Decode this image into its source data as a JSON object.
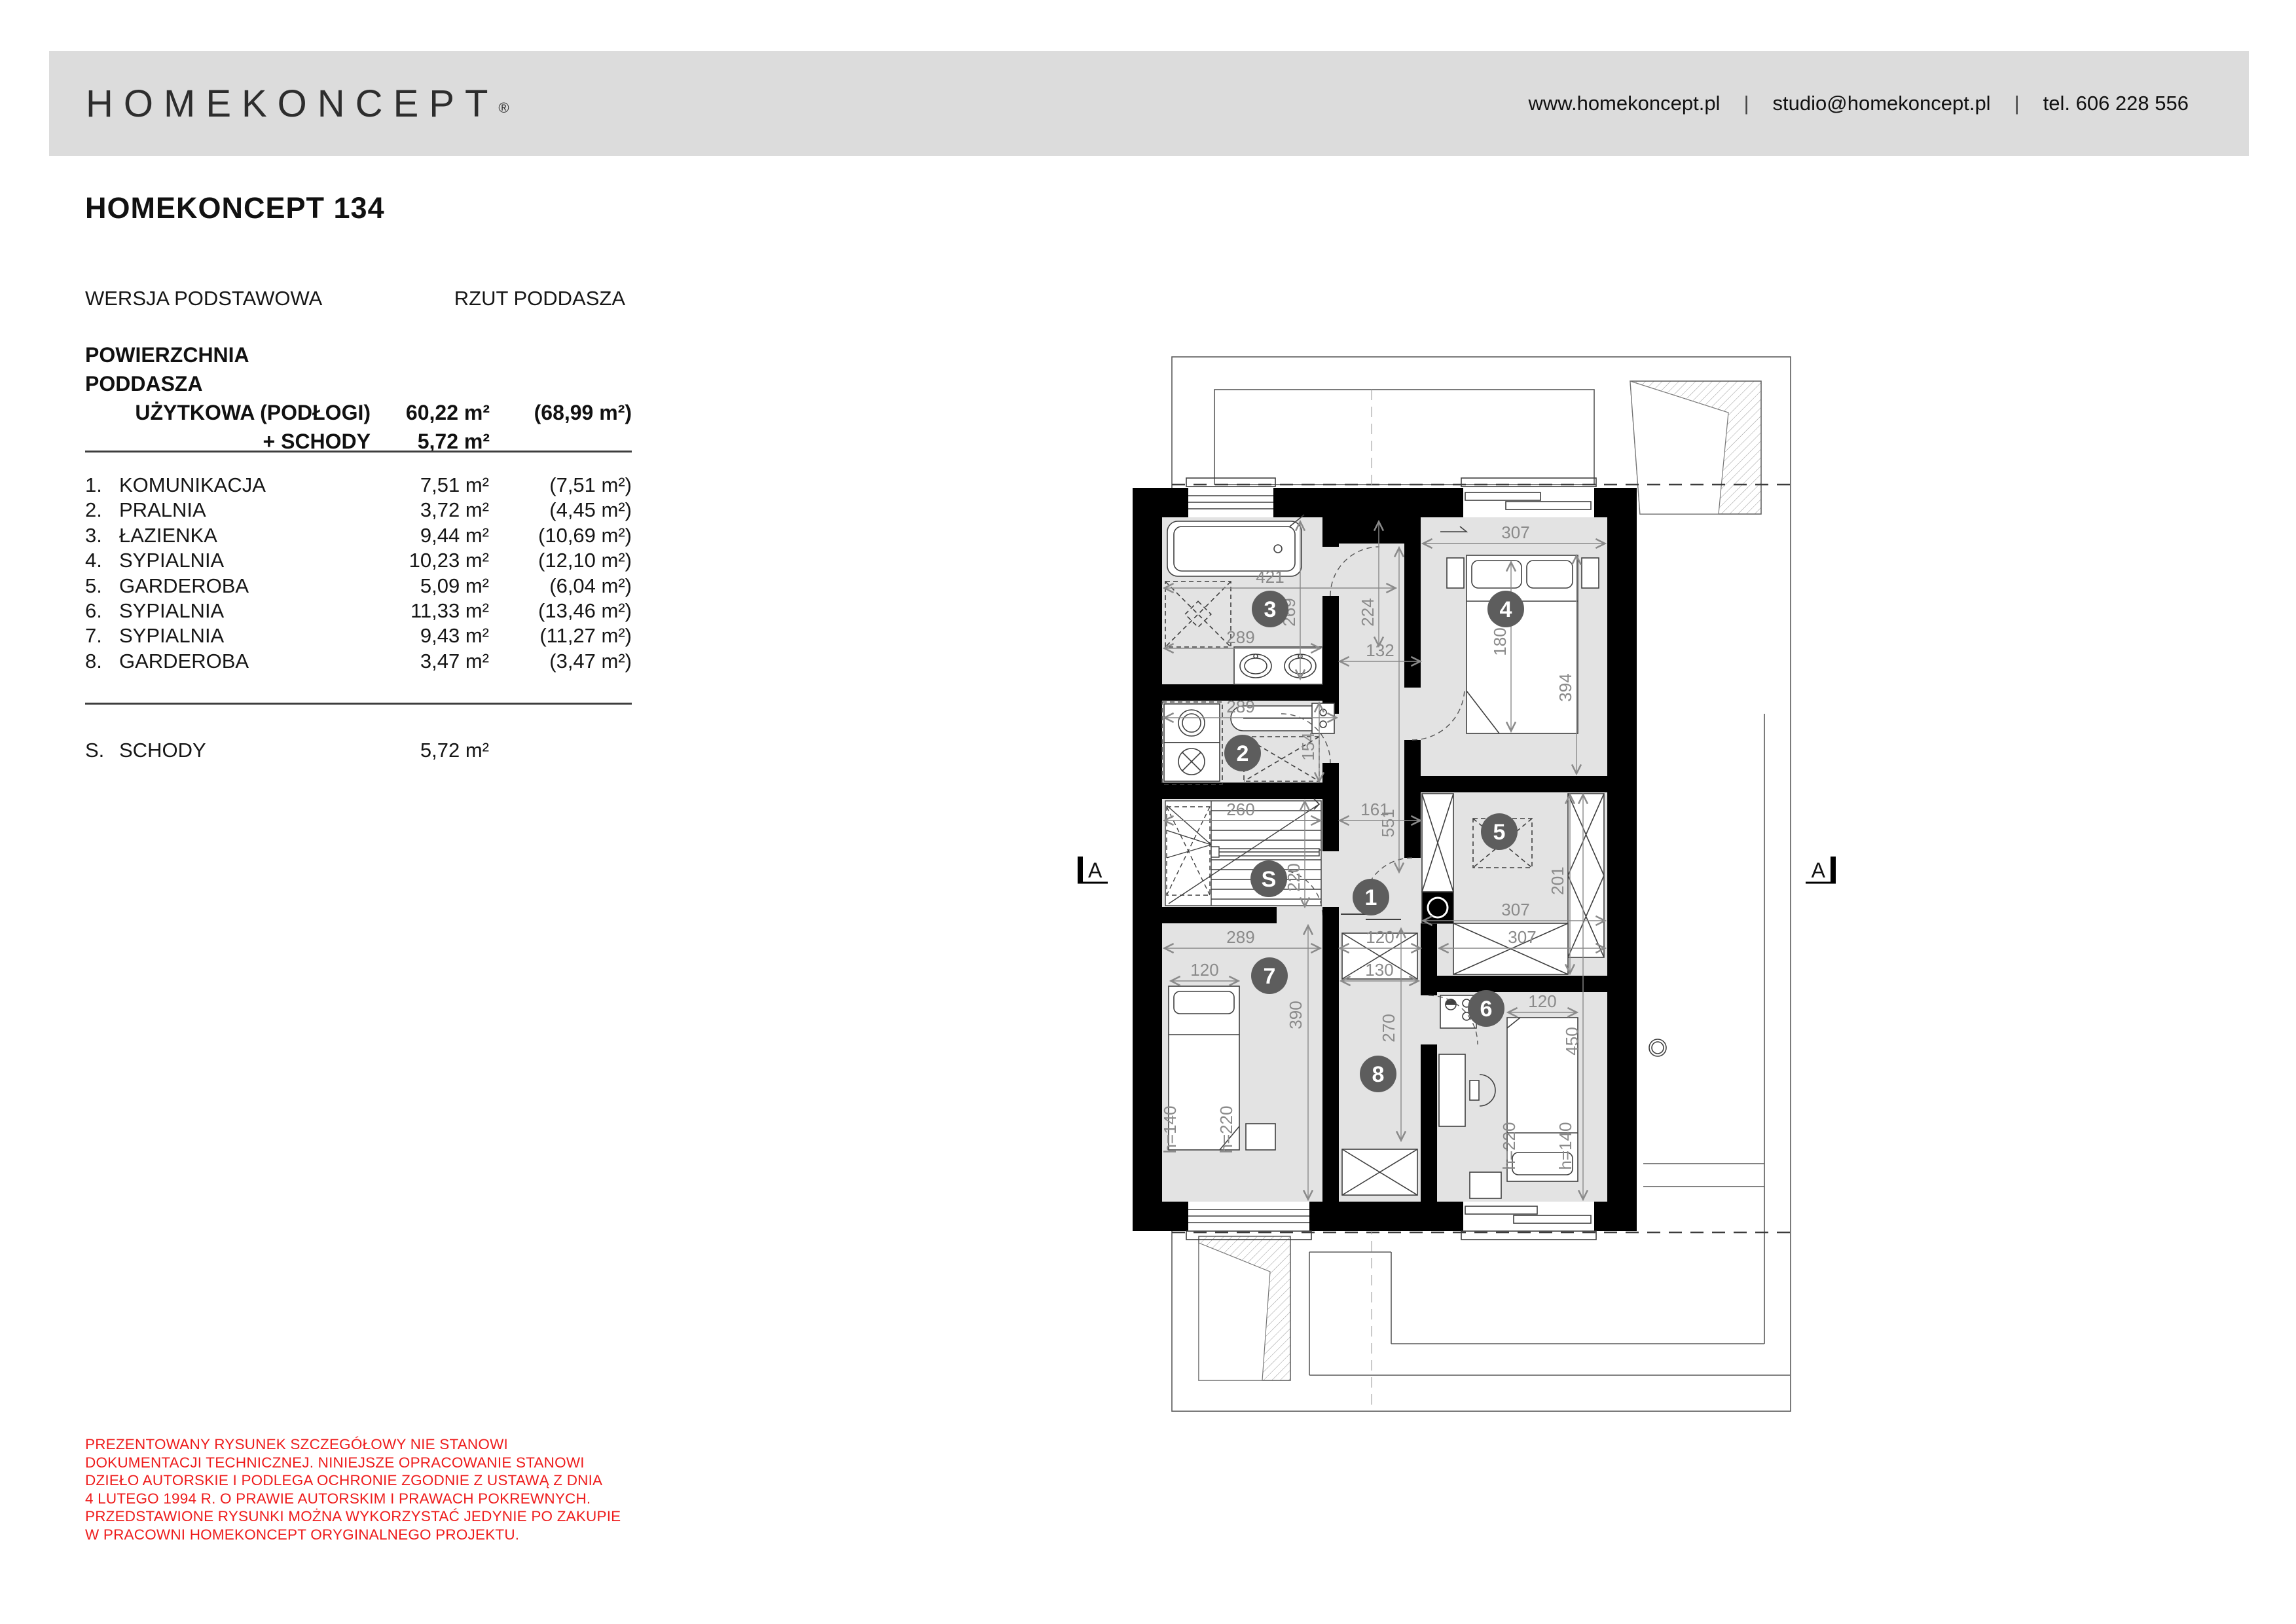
{
  "colors": {
    "header_bg": "#dcdcdc",
    "text": "#111111",
    "disclaimer_red": "#ee1c1c",
    "room_fill": "#e3e3e3",
    "wall": "#000000",
    "room_circle": "#5d5d5d",
    "dimension_gray": "#8a8a8a"
  },
  "header": {
    "logo": "HOMEKONCEPT",
    "reg": "®",
    "website": "www.homekoncept.pl",
    "separator": "|",
    "email": "studio@homekoncept.pl",
    "phone": "tel. 606 228 556"
  },
  "title": "HOMEKONCEPT 134",
  "meta": {
    "version": "WERSJA PODSTAWOWA",
    "view": "RZUT PODDASZA"
  },
  "summary": {
    "heading": "POWIERZCHNIA PODDASZA",
    "usable_label": "UŻYTKOWA (PODŁOGI)",
    "usable_value": "60,22 m²",
    "usable_total": "(68,99 m²)",
    "stairs_label": "+ SCHODY",
    "stairs_value": "5,72 m²"
  },
  "rooms": [
    {
      "no": "1.",
      "name": "KOMUNIKACJA",
      "area": "7,51 m²",
      "total": "(7,51 m²)"
    },
    {
      "no": "2.",
      "name": "PRALNIA",
      "area": "3,72 m²",
      "total": "(4,45 m²)"
    },
    {
      "no": "3.",
      "name": "ŁAZIENKA",
      "area": "9,44 m²",
      "total": "(10,69 m²)"
    },
    {
      "no": "4.",
      "name": "SYPIALNIA",
      "area": "10,23 m²",
      "total": "(12,10 m²)"
    },
    {
      "no": "5.",
      "name": "GARDEROBA",
      "area": "5,09 m²",
      "total": "(6,04 m²)"
    },
    {
      "no": "6.",
      "name": "SYPIALNIA",
      "area": "11,33 m²",
      "total": "(13,46 m²)"
    },
    {
      "no": "7.",
      "name": "SYPIALNIA",
      "area": "9,43 m²",
      "total": "(11,27 m²)"
    },
    {
      "no": "8.",
      "name": "GARDEROBA",
      "area": "3,47 m²",
      "total": "(3,47 m²)"
    }
  ],
  "stairs_row": {
    "no": "S.",
    "name": "SCHODY",
    "area": "5,72 m²"
  },
  "disclaimer": [
    "PREZENTOWANY RYSUNEK SZCZEGÓŁOWY NIE STANOWI",
    "DOKUMENTACJI TECHNICZNEJ. NINIEJSZE OPRACOWANIE STANOWI",
    "DZIEŁO AUTORSKIE I PODLEGA OCHRONIE ZGODNIE Z USTAWĄ Z DNIA",
    "4 LUTEGO 1994 R. O PRAWIE AUTORSKIM I PRAWACH POKREWNYCH.",
    "PRZEDSTAWIONE RYSUNKI MOŻNA WYKORZYSTAĆ JEDYNIE PO ZAKUPIE",
    "W PRACOWNI HOMEKONCEPT ORYGINALNEGO PROJEKTU."
  ],
  "plan": {
    "section_label": "A",
    "labels": {
      "r1": "1",
      "r2": "2",
      "r3": "3",
      "r4": "4",
      "r5": "5",
      "r6": "6",
      "r7": "7",
      "r8": "8",
      "s": "S"
    },
    "dims": {
      "d421": "421",
      "d307": "307",
      "d269": "269",
      "d224": "224",
      "d132": "132",
      "d289": "289",
      "d180": "180",
      "d394": "394",
      "d154": "154",
      "d260": "260",
      "d161": "161",
      "d551": "551",
      "d220": "220",
      "d201": "201",
      "d120": "120",
      "d390": "390",
      "d130": "130",
      "d270": "270",
      "d450": "450",
      "h140": "h=140",
      "h220": "h=220"
    }
  }
}
